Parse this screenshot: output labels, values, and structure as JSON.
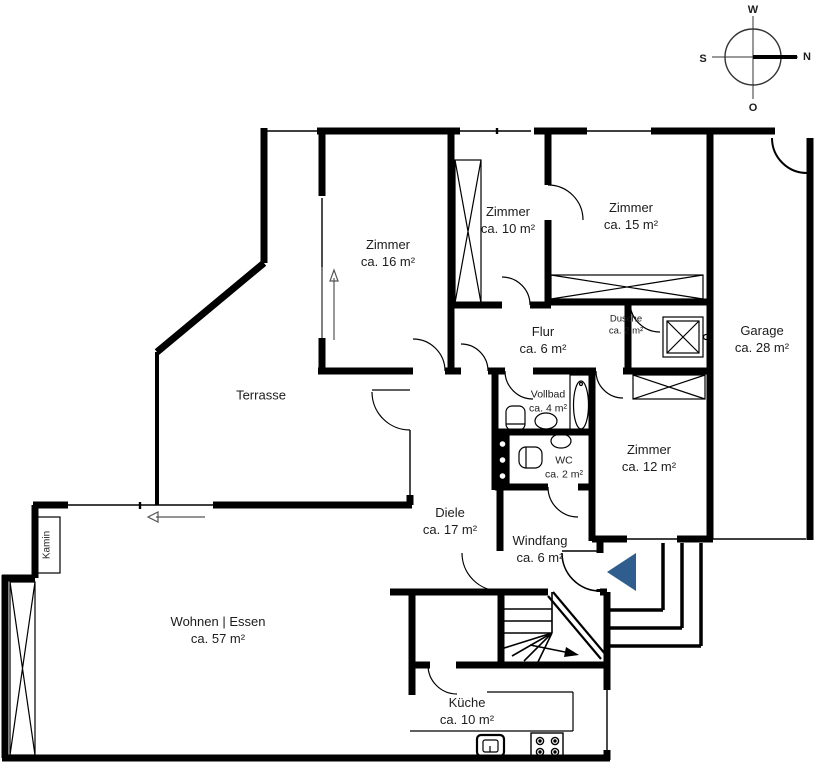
{
  "compass": {
    "top": "W",
    "right": "N",
    "left": "S",
    "bottom": "O"
  },
  "rooms": [
    {
      "id": "zimmer16",
      "name": "Zimmer",
      "area": "ca. 16 m²"
    },
    {
      "id": "zimmer10",
      "name": "Zimmer",
      "area": "ca. 10 m²"
    },
    {
      "id": "zimmer15",
      "name": "Zimmer",
      "area": "ca. 15 m²"
    },
    {
      "id": "garage",
      "name": "Garage",
      "area": "ca. 28 m²"
    },
    {
      "id": "flur",
      "name": "Flur",
      "area": "ca. 6 m²"
    },
    {
      "id": "dusche",
      "name": "Dusche",
      "area": "ca. 2 m²"
    },
    {
      "id": "terrasse",
      "name": "Terrasse",
      "area": ""
    },
    {
      "id": "vollbad",
      "name": "Vollbad",
      "area": "ca. 4 m²"
    },
    {
      "id": "wc",
      "name": "WC",
      "area": "ca. 2 m²"
    },
    {
      "id": "zimmer12",
      "name": "Zimmer",
      "area": "ca. 12 m²"
    },
    {
      "id": "diele",
      "name": "Diele",
      "area": "ca. 17 m²"
    },
    {
      "id": "windfang",
      "name": "Windfang",
      "area": "ca. 6 m²"
    },
    {
      "id": "wohnen",
      "name": "Wohnen | Essen",
      "area": "ca. 57 m²"
    },
    {
      "id": "kueche",
      "name": "Küche",
      "area": "ca. 10 m²"
    }
  ],
  "extras": {
    "kamin": "Kamin"
  },
  "colors": {
    "wall": "#000000",
    "entrance_arrow": "#2e5d8e"
  }
}
